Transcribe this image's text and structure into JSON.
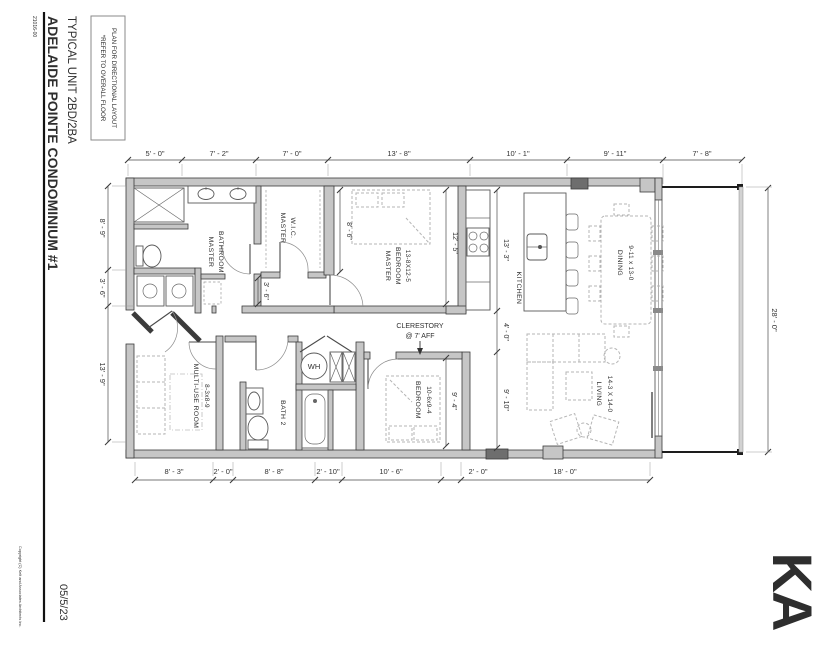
{
  "titleblock": {
    "project_number": "21016-00",
    "project_name": "ADELAIDE POINTE CONDOMINIUM #1",
    "sheet_title": "TYPICAL UNIT 2BD/2BA",
    "date": "05/5/23",
    "copyright": "Copyright (C) Kelt and Associates Architects Inc.",
    "logo": "KA"
  },
  "note": {
    "line1": "*REFER TO OVERALL FLOOR",
    "line2": "PLAN FOR DIRECTIONAL LAYOUT"
  },
  "dims": {
    "top": [
      "5' - 0\"",
      "7' - 2\"",
      "7' - 0\"",
      "13' - 8\"",
      "10' - 1\"",
      "9' - 11\"",
      "7' - 8\""
    ],
    "bottom": [
      "8' - 3\"",
      "2' - 0\"",
      "8' - 8\"",
      "2' - 10\"",
      "10' - 6\"",
      "2' - 0\"",
      "18' - 0\""
    ],
    "left": [
      "8' - 9\"",
      "3' - 6\"",
      "13' - 9\""
    ],
    "right": "28' - 0\"",
    "interior": {
      "wic_depth": "8' - 6\"",
      "mbr_depth": "12' - 5\"",
      "kitchen_len": "13' - 3\"",
      "hall_width": "3' - 6\"",
      "pass": "4' - 0\"",
      "living_w": "9' - 10\"",
      "bed2_depth": "9' - 4\""
    }
  },
  "rooms": {
    "master_bath_1": "MASTER",
    "master_bath_2": "BATHROOM",
    "wic_1": "MASTER",
    "wic_2": "W.I.C.",
    "mbr_1": "MASTER",
    "mbr_2": "BEDROOM",
    "mbr_size": "13-8X12-5",
    "kitchen": "KITCHEN",
    "dining": "DINING",
    "dining_size": "9-11 x 13-0",
    "living": "LIVING",
    "living_size": "14-3 X 14-0",
    "bedroom": "BEDROOM",
    "bedroom_size": "10-6x9-4",
    "bath2": "BATH 2",
    "multiuse": "MULTI-USE ROOM",
    "multiuse_size": "8-3x8-9",
    "wh": "WH",
    "clerestory_1": "CLERESTORY",
    "clerestory_2": "@ 7' AFF"
  }
}
